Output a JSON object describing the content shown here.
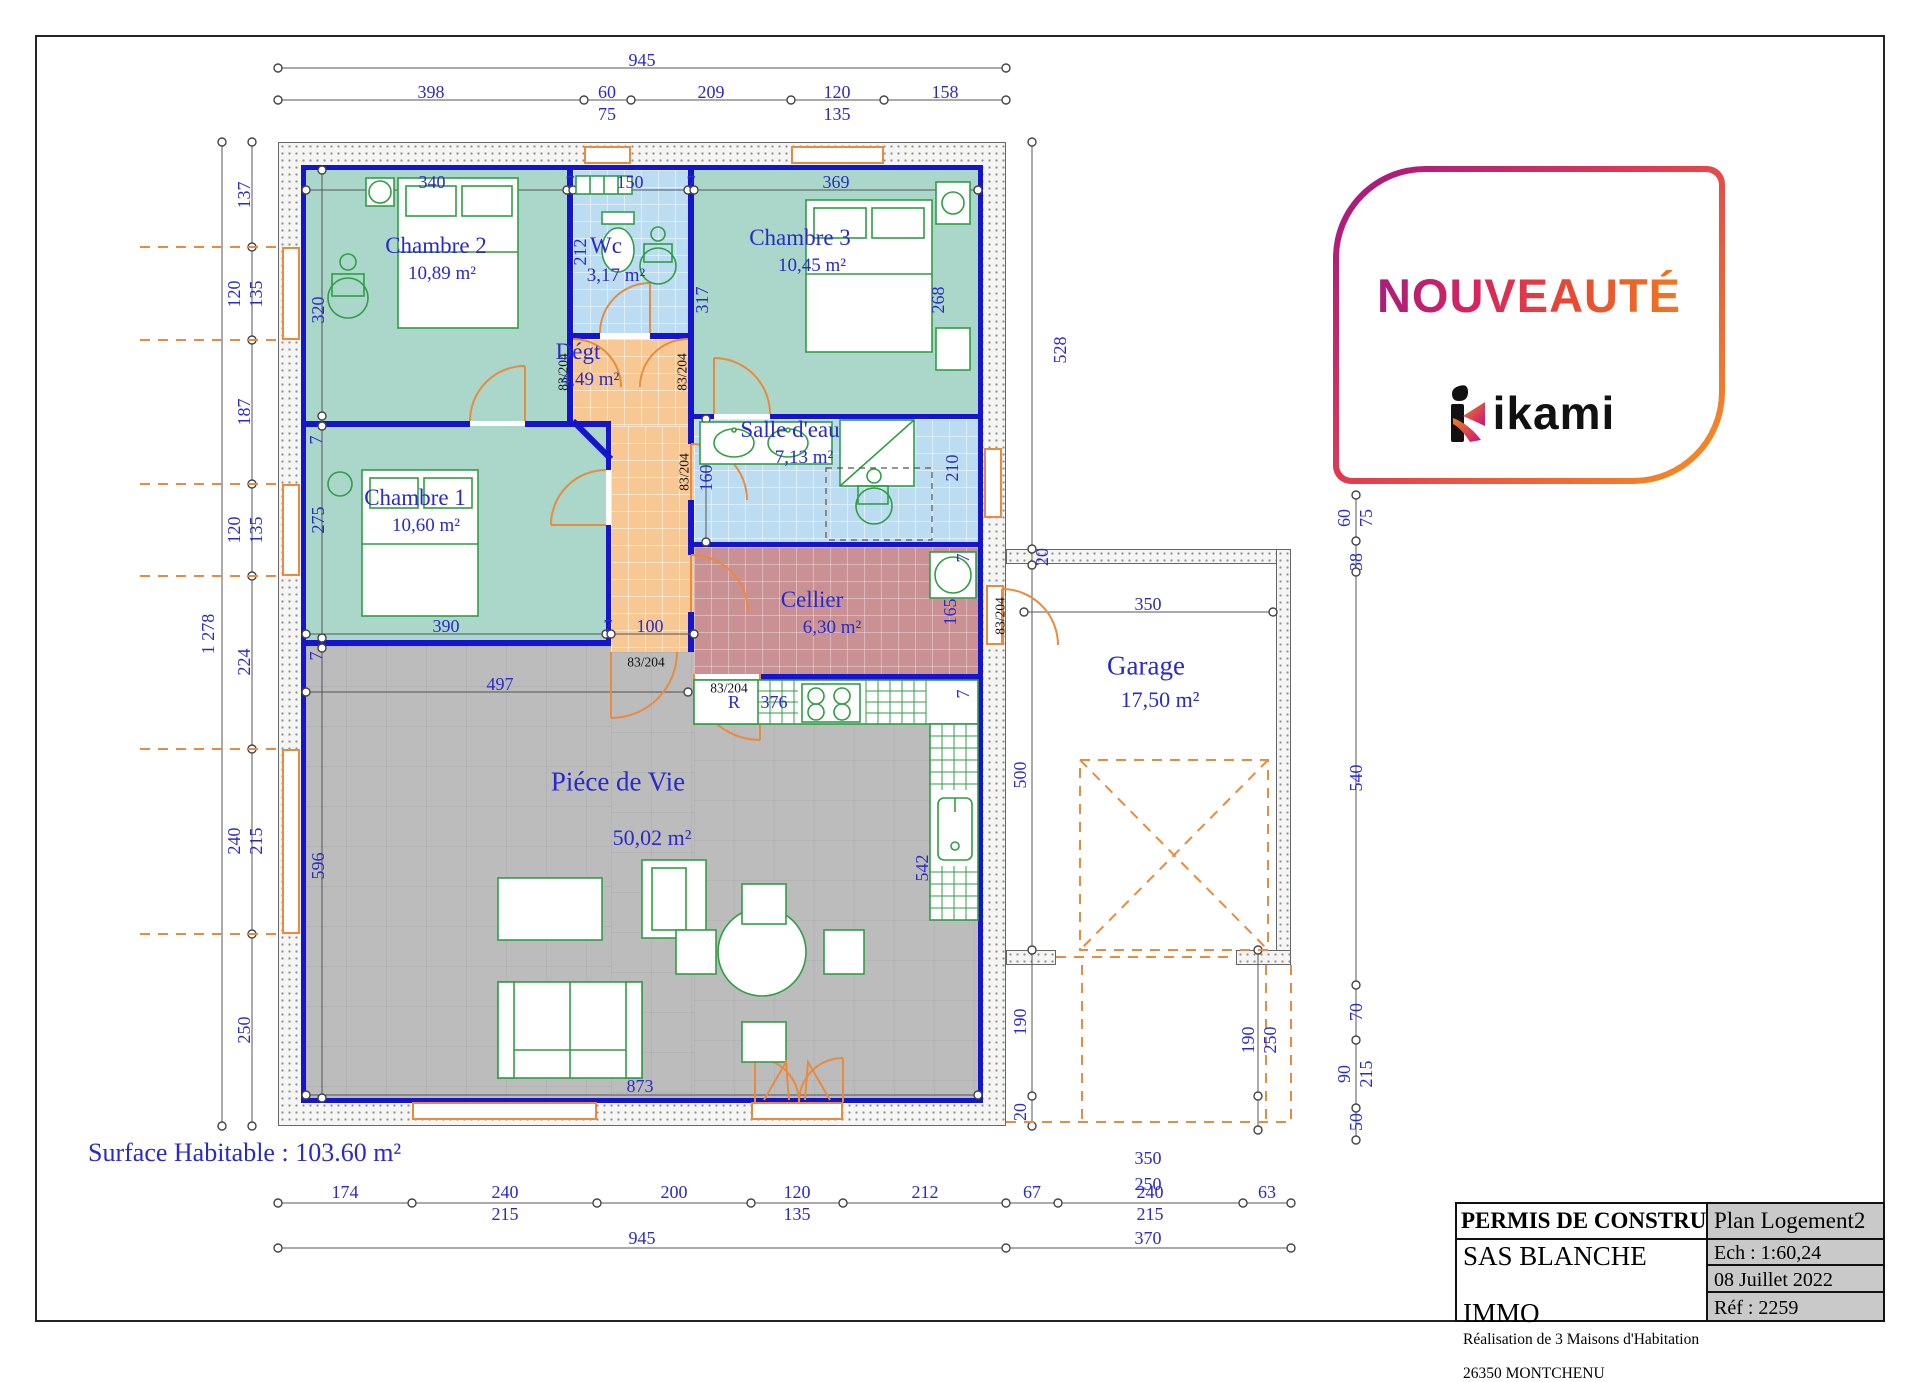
{
  "badge": {
    "title": "NOUVEAUTÉ",
    "brand": "ikami"
  },
  "title_block": {
    "doc_type": "PERMIS DE CONSTRUIRE",
    "plan_name": "Plan Logement2",
    "company_line1": "SAS BLANCHE",
    "company_line2": "IMMO",
    "desc_line1": "Réalisation de 3 Maisons d'Habitation",
    "desc_line2": "26350 MONTCHENU",
    "scale": "Ech : 1:60,24",
    "date": "08 Juillet 2022",
    "reference": "Réf : 2259"
  },
  "plan": {
    "surface_label": "Surface Habitable : 103.60 m²",
    "colors": {
      "wall": "#1515cb",
      "dim_text": "#2a2ac8",
      "bedroom": "#aad7c9",
      "wet_room": "#bcdcf2",
      "corridor": "#f7c894",
      "cellar": "#c99193",
      "living": "#bcbcbc",
      "furniture": "#2f9e44",
      "door": "#e98b3f"
    },
    "rooms": [
      {
        "id": "chambre2",
        "name": "Chambre 2",
        "area": "10,89 m²",
        "nx": 436,
        "ny": 246,
        "ax": 442,
        "ay": 274
      },
      {
        "id": "wc",
        "name": "Wc",
        "area": "3,17 m²",
        "nx": 606,
        "ny": 246,
        "ax": 616,
        "ay": 276
      },
      {
        "id": "chambre3",
        "name": "Chambre 3",
        "area": "10,45 m²",
        "nx": 800,
        "ny": 238,
        "ax": 812,
        "ay": 266
      },
      {
        "id": "degt",
        "name": "Dégt",
        "area": "4,49 m²",
        "nx": 578,
        "ny": 352,
        "ax": 590,
        "ay": 380
      },
      {
        "id": "chambre1",
        "name": "Chambre 1",
        "area": "10,60 m²",
        "nx": 415,
        "ny": 498,
        "ax": 426,
        "ay": 526
      },
      {
        "id": "salle-deau",
        "name": "Salle d'eau",
        "area": "7,13 m²",
        "nx": 790,
        "ny": 430,
        "ax": 804,
        "ay": 458
      },
      {
        "id": "cellier",
        "name": "Cellier",
        "area": "6,30 m²",
        "nx": 812,
        "ny": 600,
        "ax": 832,
        "ay": 628
      },
      {
        "id": "piece-de-vie",
        "name": "Piéce de Vie",
        "area": "50,02 m²",
        "nx": 618,
        "ny": 782,
        "ax": 652,
        "ay": 838,
        "big": true
      },
      {
        "id": "garage",
        "name": "Garage",
        "area": "17,50 m²",
        "nx": 1146,
        "ny": 666,
        "ax": 1160,
        "ay": 700,
        "big": true
      }
    ],
    "dims": [
      {
        "t": "945",
        "x": 642,
        "y": 60
      },
      {
        "t": "398",
        "x": 431,
        "y": 92
      },
      {
        "t": "60",
        "x": 607,
        "y": 92
      },
      {
        "t": "75",
        "x": 607,
        "y": 114
      },
      {
        "t": "209",
        "x": 711,
        "y": 92
      },
      {
        "t": "120",
        "x": 837,
        "y": 92
      },
      {
        "t": "135",
        "x": 837,
        "y": 114
      },
      {
        "t": "158",
        "x": 945,
        "y": 92
      },
      {
        "t": "1 278",
        "x": 208,
        "y": 634,
        "o": "v"
      },
      {
        "t": "137",
        "x": 244,
        "y": 195,
        "o": "v"
      },
      {
        "t": "120",
        "x": 234,
        "y": 294,
        "o": "v"
      },
      {
        "t": "135",
        "x": 256,
        "y": 294,
        "o": "v"
      },
      {
        "t": "187",
        "x": 244,
        "y": 412,
        "o": "v"
      },
      {
        "t": "120",
        "x": 234,
        "y": 530,
        "o": "v"
      },
      {
        "t": "135",
        "x": 256,
        "y": 530,
        "o": "v"
      },
      {
        "t": "224",
        "x": 244,
        "y": 662,
        "o": "v"
      },
      {
        "t": "240",
        "x": 234,
        "y": 841,
        "o": "v"
      },
      {
        "t": "215",
        "x": 256,
        "y": 841,
        "o": "v"
      },
      {
        "t": "250",
        "x": 244,
        "y": 1030,
        "o": "v"
      },
      {
        "t": "528",
        "x": 1060,
        "y": 350,
        "o": "v"
      },
      {
        "t": "20",
        "x": 1042,
        "y": 557,
        "o": "v"
      },
      {
        "t": "500",
        "x": 1020,
        "y": 775,
        "o": "v"
      },
      {
        "t": "190",
        "x": 1020,
        "y": 1022,
        "o": "v"
      },
      {
        "t": "20",
        "x": 1020,
        "y": 1112,
        "o": "v"
      },
      {
        "t": "60",
        "x": 1344,
        "y": 518,
        "o": "v"
      },
      {
        "t": "75",
        "x": 1366,
        "y": 518,
        "o": "v"
      },
      {
        "t": "38",
        "x": 1356,
        "y": 562,
        "o": "v"
      },
      {
        "t": "540",
        "x": 1356,
        "y": 778,
        "o": "v"
      },
      {
        "t": "70",
        "x": 1356,
        "y": 1012,
        "o": "v"
      },
      {
        "t": "90",
        "x": 1344,
        "y": 1074,
        "o": "v"
      },
      {
        "t": "215",
        "x": 1366,
        "y": 1074,
        "o": "v"
      },
      {
        "t": "50",
        "x": 1356,
        "y": 1122,
        "o": "v"
      },
      {
        "t": "190",
        "x": 1248,
        "y": 1040,
        "o": "v"
      },
      {
        "t": "250",
        "x": 1270,
        "y": 1040,
        "o": "v"
      },
      {
        "t": "350",
        "x": 1148,
        "y": 604
      },
      {
        "t": "350",
        "x": 1148,
        "y": 1158
      },
      {
        "t": "250",
        "x": 1148,
        "y": 1184
      },
      {
        "t": "174",
        "x": 345,
        "y": 1192
      },
      {
        "t": "240",
        "x": 505,
        "y": 1192
      },
      {
        "t": "215",
        "x": 505,
        "y": 1214
      },
      {
        "t": "200",
        "x": 674,
        "y": 1192
      },
      {
        "t": "120",
        "x": 797,
        "y": 1192
      },
      {
        "t": "135",
        "x": 797,
        "y": 1214
      },
      {
        "t": "212",
        "x": 925,
        "y": 1192
      },
      {
        "t": "67",
        "x": 1032,
        "y": 1192
      },
      {
        "t": "240",
        "x": 1150,
        "y": 1192
      },
      {
        "t": "215",
        "x": 1150,
        "y": 1214
      },
      {
        "t": "63",
        "x": 1267,
        "y": 1192
      },
      {
        "t": "945",
        "x": 642,
        "y": 1238
      },
      {
        "t": "370",
        "x": 1148,
        "y": 1238
      },
      {
        "t": "340",
        "x": 432,
        "y": 182
      },
      {
        "t": "7",
        "x": 570,
        "y": 182
      },
      {
        "t": "150",
        "x": 630,
        "y": 182
      },
      {
        "t": "7",
        "x": 691,
        "y": 182
      },
      {
        "t": "369",
        "x": 836,
        "y": 182
      },
      {
        "t": "212",
        "x": 580,
        "y": 252,
        "o": "v"
      },
      {
        "t": "317",
        "x": 702,
        "y": 300,
        "o": "v"
      },
      {
        "t": "268",
        "x": 938,
        "y": 300,
        "o": "v"
      },
      {
        "t": "320",
        "x": 318,
        "y": 310,
        "o": "v"
      },
      {
        "t": "275",
        "x": 318,
        "y": 520,
        "o": "v"
      },
      {
        "t": "390",
        "x": 446,
        "y": 626
      },
      {
        "t": "7",
        "x": 608,
        "y": 626
      },
      {
        "t": "100",
        "x": 650,
        "y": 626
      },
      {
        "t": "497",
        "x": 500,
        "y": 684
      },
      {
        "t": "873",
        "x": 640,
        "y": 1086
      },
      {
        "t": "596",
        "x": 318,
        "y": 866,
        "o": "v"
      },
      {
        "t": "160",
        "x": 706,
        "y": 478,
        "o": "v"
      },
      {
        "t": "210",
        "x": 952,
        "y": 468,
        "o": "v"
      },
      {
        "t": "165",
        "x": 950,
        "y": 612,
        "o": "v"
      },
      {
        "t": "542",
        "x": 922,
        "y": 868,
        "o": "v"
      },
      {
        "t": "376",
        "x": 774,
        "y": 702
      },
      {
        "t": "R",
        "x": 734,
        "y": 702
      },
      {
        "t": "7",
        "x": 316,
        "y": 440,
        "o": "v"
      },
      {
        "t": "7",
        "x": 316,
        "y": 656,
        "o": "v"
      },
      {
        "t": "7",
        "x": 963,
        "y": 558,
        "o": "v"
      },
      {
        "t": "7",
        "x": 963,
        "y": 694,
        "o": "v"
      },
      {
        "t": "83/204",
        "x": 563,
        "y": 372,
        "o": "v",
        "k": 1
      },
      {
        "t": "83/204",
        "x": 682,
        "y": 372,
        "o": "v",
        "k": 1
      },
      {
        "t": "83/204",
        "x": 684,
        "y": 472,
        "o": "v",
        "k": 1
      },
      {
        "t": "83/204",
        "x": 646,
        "y": 662,
        "k": 1
      },
      {
        "t": "83/204",
        "x": 729,
        "y": 688,
        "k": 1
      },
      {
        "t": "83/204",
        "x": 1000,
        "y": 616,
        "o": "v",
        "k": 1
      }
    ]
  }
}
